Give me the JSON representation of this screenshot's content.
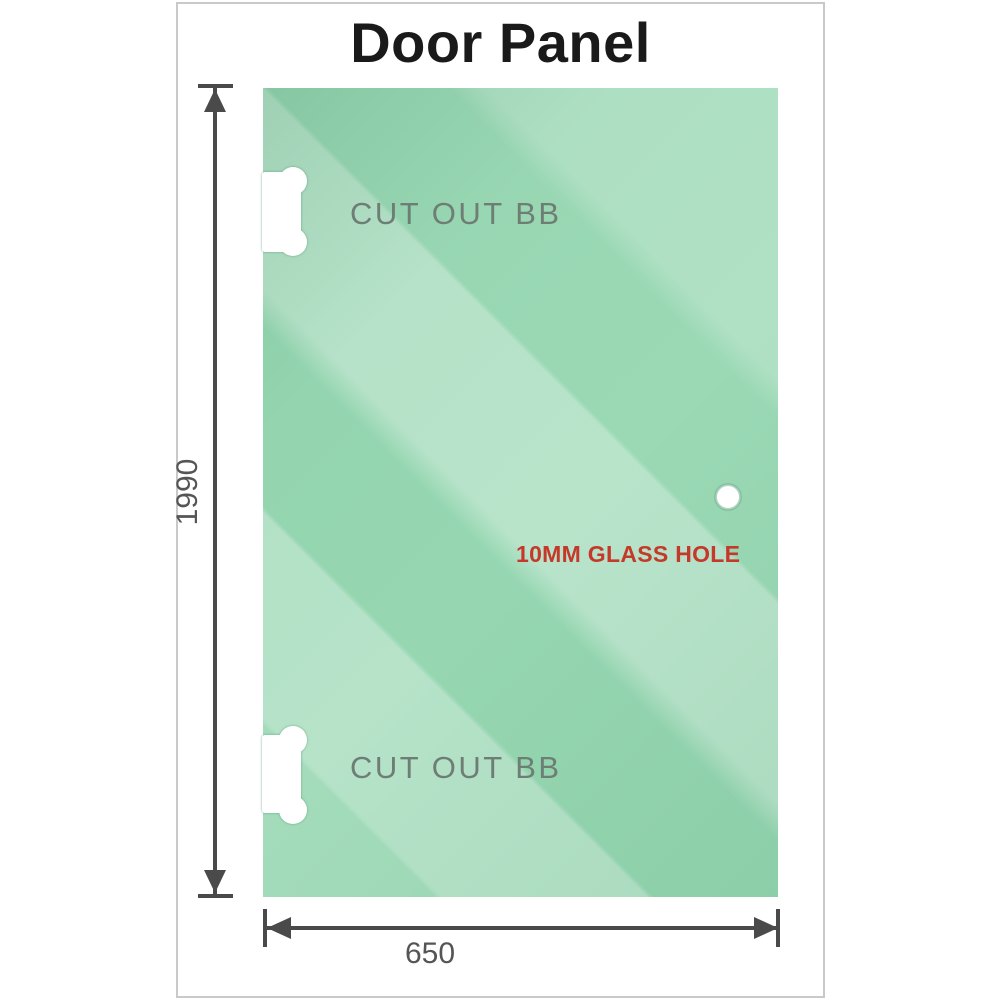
{
  "page": {
    "title": "Door Panel"
  },
  "colors": {
    "glass_green": "#7ccd9e",
    "dimension_gray": "#4a4a4a",
    "dim_text_gray": "#555555",
    "cutout_label_gray": "#6e7e75",
    "hole_label_red": "#c5392b",
    "sheet_border": "#c9c9c9",
    "title_black": "#1a1a1a",
    "cutout_white": "#ffffff"
  },
  "panel": {
    "cutouts": [
      {
        "label": "CUT OUT BB",
        "position": "top-left"
      },
      {
        "label": "CUT OUT BB",
        "position": "bottom-left"
      }
    ],
    "hole": {
      "label": "10MM GLASS HOLE"
    }
  },
  "dimensions": {
    "height_mm": "1990",
    "width_mm": "650"
  }
}
